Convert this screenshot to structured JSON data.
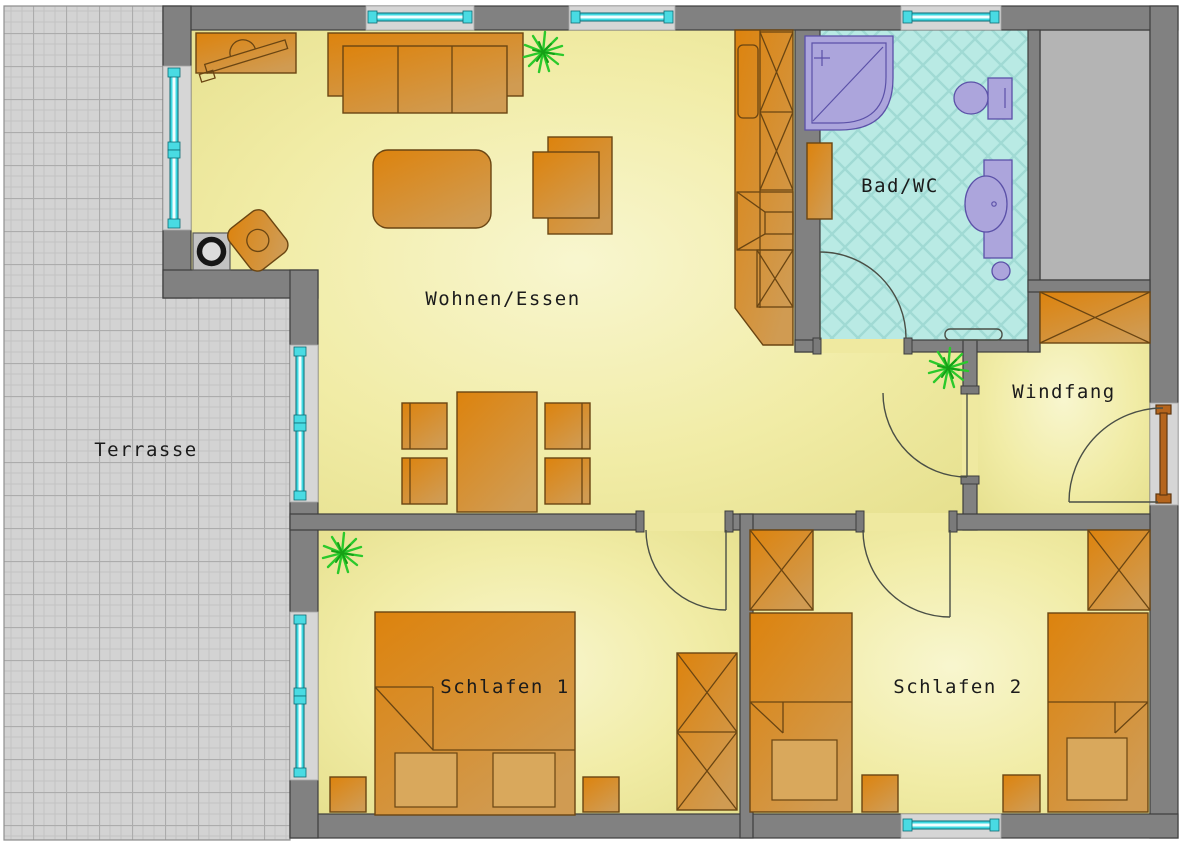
{
  "plan": {
    "type": "architectural floor plan",
    "language": "de",
    "rooms_count": 6
  },
  "rooms": {
    "terrasse": {
      "label": "Terrasse"
    },
    "wohnen_essen": {
      "label": "Wohnen/Essen",
      "furniture": [
        "sofa",
        "armchair",
        "coffee-table",
        "tv-sideboard",
        "wood-stove",
        "side-chair",
        "dining-table",
        "dining-chairs-x4",
        "kitchen-unit",
        "plant-x2"
      ]
    },
    "bad_wc": {
      "label": "Bad/WC",
      "furniture": [
        "corner-shower",
        "toilet",
        "washbasin",
        "radiator",
        "bath-mat"
      ]
    },
    "windfang": {
      "label": "Windfang",
      "furniture": [
        "wardrobe"
      ]
    },
    "schlafen1": {
      "label": "Schlafen 1",
      "furniture": [
        "double-bed",
        "nightstand-x2",
        "wardrobe",
        "plant"
      ]
    },
    "schlafen2": {
      "label": "Schlafen 2",
      "furniture": [
        "single-bed-x2",
        "nightstand-x2",
        "wardrobe-x2"
      ]
    }
  },
  "openings": {
    "windows": 7,
    "entrance_door": 1,
    "interior_doors": 4
  },
  "colors": {
    "wall": "#818181",
    "wall_outline": "#3d3d3d",
    "floor_yellow": "#f1eca6",
    "terrace_gray": "#d3d3d3",
    "bath_tile": "#b9eae4",
    "furniture_orange": "#d6891f",
    "furniture_outline": "#6a4512",
    "sanitary_purple": "#aca5dc",
    "window_cyan": "#3fd9e2",
    "door_brown": "#b5651d",
    "plant_green": "#2bc92b"
  }
}
